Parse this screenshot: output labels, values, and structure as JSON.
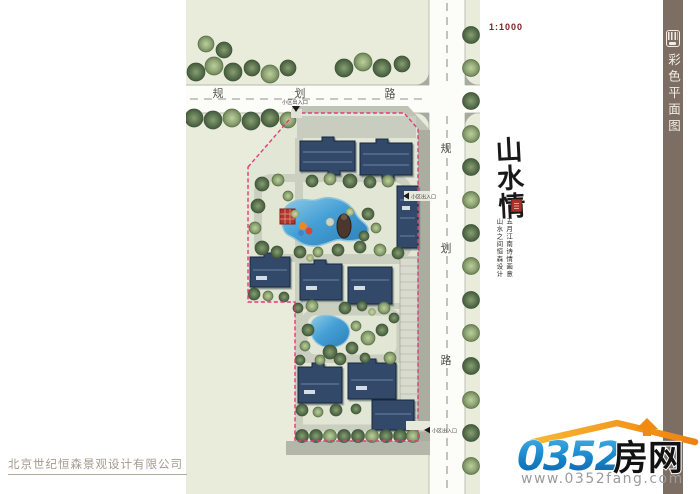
{
  "sidebar": {
    "title": "彩色平面图",
    "bg_color": "#7c6e63",
    "icon": "plan-sheet-icon"
  },
  "plan": {
    "scale_label": "1:1000",
    "road_label_chars": [
      "规",
      "划",
      "路"
    ],
    "entrance_label": "小区出入口",
    "colors": {
      "ground_green": "#e9ecdb",
      "road_white": "#fcfcf9",
      "sidewalk_gray": "#aaad9f",
      "building_blue": "#32496a",
      "water_blue": "#45a0d6",
      "boundary_pink": "#e4387c",
      "pavilion_red": "#b5352b"
    }
  },
  "artwork": {
    "title": "山水情",
    "inscription_col1": "五月江南诗情画意",
    "inscription_col2": "山水之间恒森设计",
    "seal_color": "#a8322a"
  },
  "footer": {
    "company": "北京世纪恒森景观设计有限公司"
  },
  "watermark": {
    "number_text": "0352",
    "cn_text": "房网",
    "url_text": "www.0352fang.com",
    "blue": "#1583c7",
    "orange": "#f59d1c"
  }
}
